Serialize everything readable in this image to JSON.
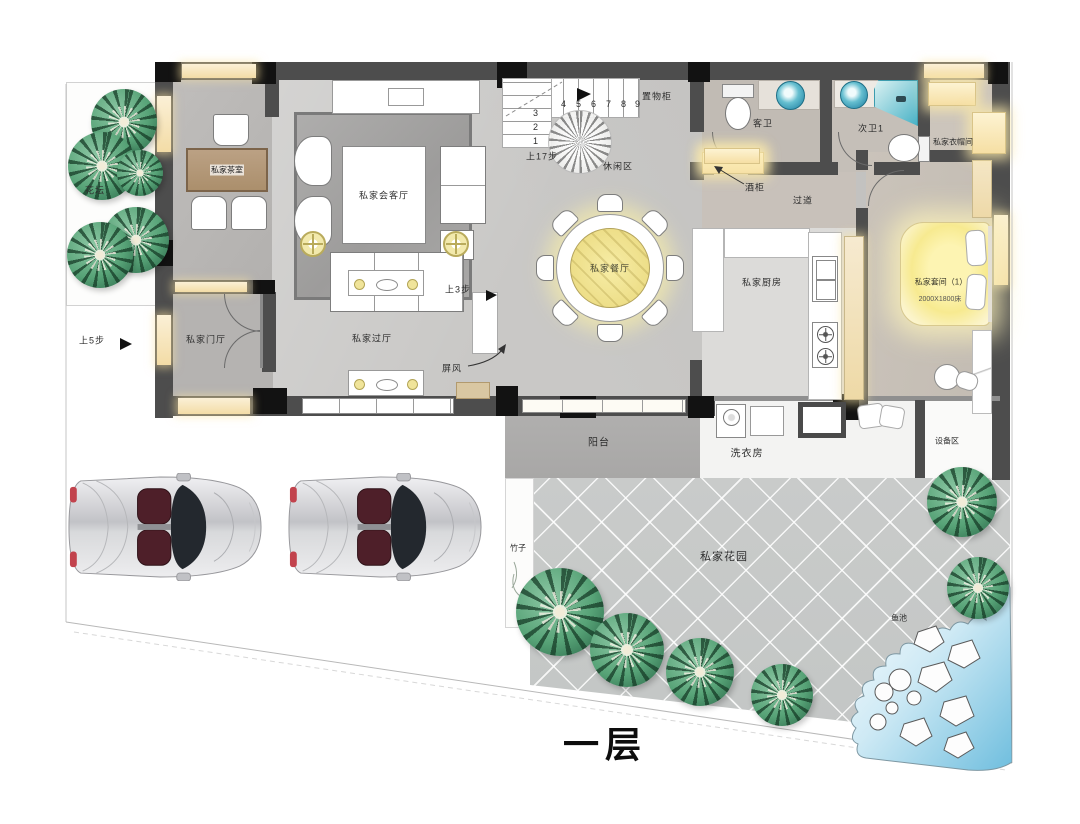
{
  "title": "一层",
  "site": {
    "flower_bed": "花坛",
    "bamboo": "竹子",
    "garden": "私家花园",
    "pond": "鱼池",
    "equipment_area": "设备区"
  },
  "rooms": {
    "tea_room": "私家茶室",
    "living": "私家会客厅",
    "foyer": "私家门厅",
    "hall": "私家过厅",
    "leisure": "休闲区",
    "dining": "私家餐厅",
    "kitchen": "私家厨房",
    "guest_bath": "客卫",
    "second_bath": "次卫1",
    "cloakroom": "私家衣帽间",
    "corridor": "过道",
    "suite": "私家套间（1）",
    "suite_bed": "2000X1800床",
    "balcony": "阳台",
    "laundry": "洗衣房"
  },
  "fixtures": {
    "storage_cabinet": "置物柜",
    "wine_cabinet": "酒柜",
    "screen": "屏风"
  },
  "stairs": {
    "up5": "上5步",
    "up3": "上3步",
    "up17": "上17步",
    "flight_down": [
      "3",
      "2",
      "1"
    ],
    "flight_up": [
      "4",
      "5",
      "6",
      "7",
      "8",
      "9"
    ]
  }
}
